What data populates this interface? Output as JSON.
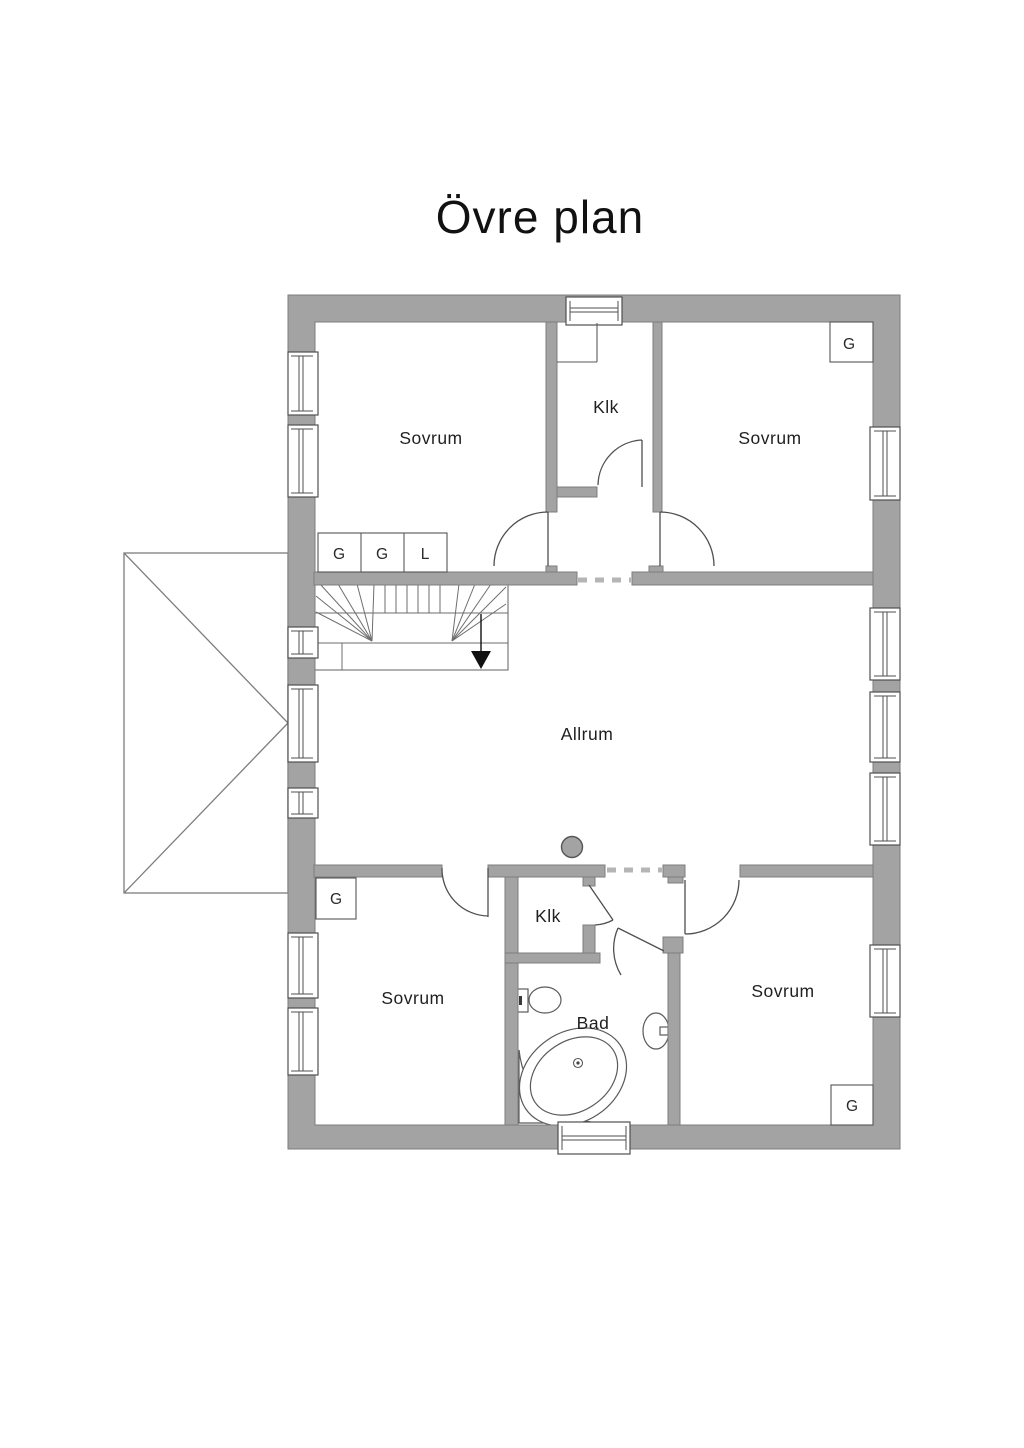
{
  "title": "Övre plan",
  "floor_plan": {
    "rooms": {
      "bedroom_top_left": "Sovrum",
      "closet_top": "Klk",
      "bedroom_top_right": "Sovrum",
      "living_room": "Allrum",
      "bedroom_bottom_left": "Sovrum",
      "closet_bottom": "Klk",
      "bathroom": "Bad",
      "bedroom_bottom_right": "Sovrum"
    },
    "wardrobes": {
      "top_left_row": [
        "G",
        "G",
        "L"
      ],
      "top_right": "G",
      "bottom_left": "G",
      "bottom_right": "G"
    },
    "colors": {
      "wall": "#a3a3a3",
      "wall_outline": "#7e7e7e",
      "line": "#4f4f4f",
      "dash": "#b5b5b5",
      "text": "#1f1f1f",
      "arrow": "#111111"
    }
  }
}
